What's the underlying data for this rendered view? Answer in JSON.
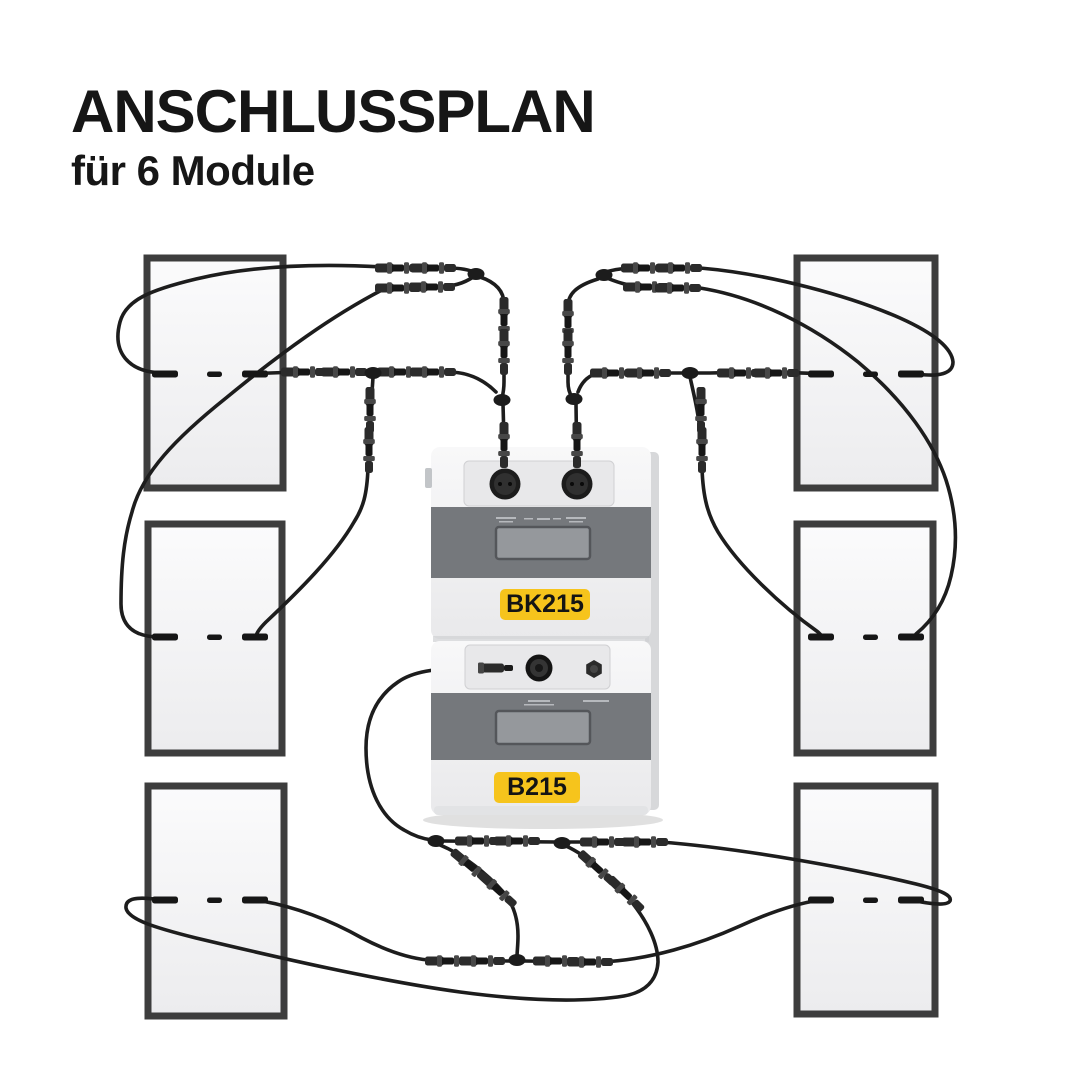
{
  "header": {
    "title": "ANSCHLUSSPLAN",
    "subtitle": "für 6 Module"
  },
  "device": {
    "top_unit_label": "BK215",
    "bottom_unit_label": "B215",
    "label_bg": "#F6C41C",
    "label_text_color": "#141414"
  },
  "diagram": {
    "module_count": 6,
    "panels": [
      {
        "id": "top-left"
      },
      {
        "id": "middle-left"
      },
      {
        "id": "bottom-left"
      },
      {
        "id": "top-right"
      },
      {
        "id": "middle-right"
      },
      {
        "id": "bottom-right"
      }
    ],
    "colors": {
      "background": "#ffffff",
      "title_text": "#161616",
      "panel_frame": "#3d3d3d",
      "panel_fill": "#f7f7f8",
      "cable": "#1d1d1d",
      "connector": "#2b2b2b",
      "device_body": "#f1f1f2",
      "device_band": "#75787c",
      "display_window": "#95989c",
      "accent_yellow": "#F6C41C"
    }
  }
}
